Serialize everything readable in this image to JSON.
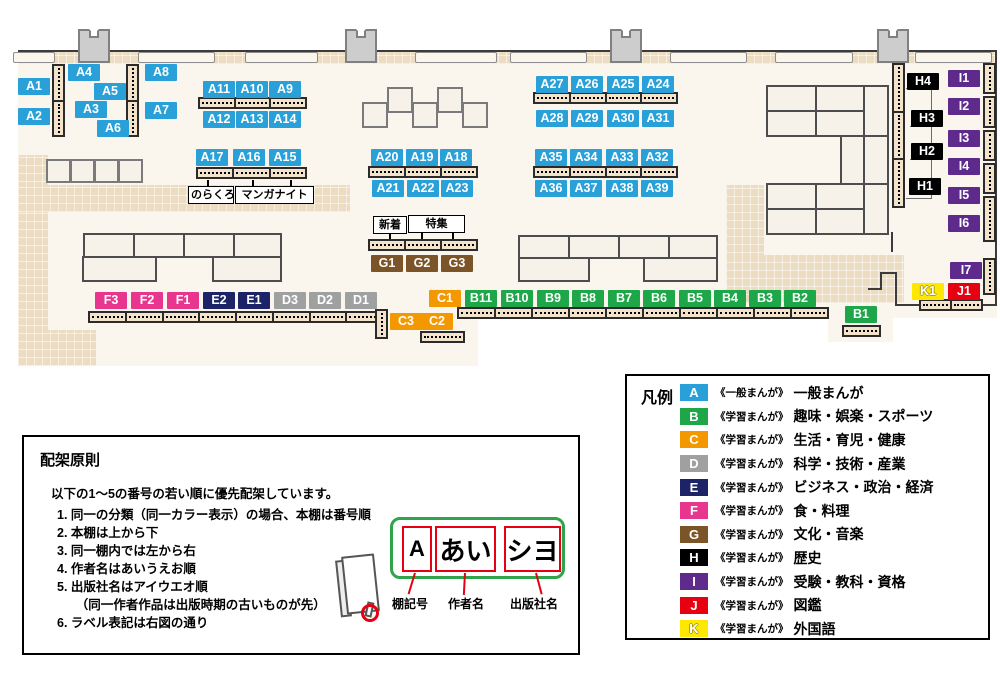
{
  "map": {
    "badges": {
      "A1": "A1",
      "A2": "A2",
      "A3": "A3",
      "A4": "A4",
      "A5": "A5",
      "A6": "A6",
      "A7": "A7",
      "A8": "A8",
      "A9": "A9",
      "A10": "A10",
      "A11": "A11",
      "A12": "A12",
      "A13": "A13",
      "A14": "A14",
      "A15": "A15",
      "A16": "A16",
      "A17": "A17",
      "A18": "A18",
      "A19": "A19",
      "A20": "A20",
      "A21": "A21",
      "A22": "A22",
      "A23": "A23",
      "A24": "A24",
      "A25": "A25",
      "A26": "A26",
      "A27": "A27",
      "A28": "A28",
      "A29": "A29",
      "A30": "A30",
      "A31": "A31",
      "A32": "A32",
      "A33": "A33",
      "A34": "A34",
      "A35": "A35",
      "A36": "A36",
      "A37": "A37",
      "A38": "A38",
      "A39": "A39",
      "B1": "B1",
      "B2": "B2",
      "B3": "B3",
      "B4": "B4",
      "B5": "B5",
      "B6": "B6",
      "B7": "B7",
      "B8": "B8",
      "B9": "B9",
      "B10": "B10",
      "B11": "B11",
      "C1": "C1",
      "C2": "C2",
      "C3": "C3",
      "D1": "D1",
      "D2": "D2",
      "D3": "D3",
      "E1": "E1",
      "E2": "E2",
      "F1": "F1",
      "F2": "F2",
      "F3": "F3",
      "G1": "G1",
      "G2": "G2",
      "G3": "G3",
      "H1": "H1",
      "H2": "H2",
      "H3": "H3",
      "H4": "H4",
      "I1": "I1",
      "I2": "I2",
      "I3": "I3",
      "I4": "I4",
      "I5": "I5",
      "I6": "I6",
      "I7": "I7",
      "J1": "J1",
      "K1": "K1"
    },
    "annotations": {
      "norakuro": "のらくろ",
      "manganight": "マンガナイト",
      "new_arrivals": "新着",
      "feature": "特集"
    }
  },
  "legend": {
    "title": "凡例",
    "items": [
      {
        "letter": "A",
        "category": "《一般まんが》",
        "label": "一般まんが",
        "color": "#29a0d8"
      },
      {
        "letter": "B",
        "category": "《学習まんが》",
        "label": "趣味・娯楽・スポーツ",
        "color": "#1ea748"
      },
      {
        "letter": "C",
        "category": "《学習まんが》",
        "label": "生活・育児・健康",
        "color": "#f39800"
      },
      {
        "letter": "D",
        "category": "《学習まんが》",
        "label": "科学・技術・産業",
        "color": "#9fa0a0"
      },
      {
        "letter": "E",
        "category": "《学習まんが》",
        "label": "ビジネス・政治・経済",
        "color": "#1c2467"
      },
      {
        "letter": "F",
        "category": "《学習まんが》",
        "label": "食・料理",
        "color": "#e8368f"
      },
      {
        "letter": "G",
        "category": "《学習まんが》",
        "label": "文化・音楽",
        "color": "#7b5527"
      },
      {
        "letter": "H",
        "category": "《学習まんが》",
        "label": "歴史",
        "color": "#000000"
      },
      {
        "letter": "I",
        "category": "《学習まんが》",
        "label": "受験・教科・資格",
        "color": "#5e2b8d"
      },
      {
        "letter": "J",
        "category": "《学習まんが》",
        "label": "図鑑",
        "color": "#e60012"
      },
      {
        "letter": "K",
        "category": "《学習まんが》",
        "label": "外国語",
        "color": "#ffe800"
      }
    ]
  },
  "principles": {
    "title": "配架原則",
    "intro": "以下の1～5の番号の若い順に優先配架しています。",
    "rules": [
      "1. 同一の分類（同一カラー表示）の場合、本棚は番号順",
      "2. 本棚は上から下",
      "3. 同一棚内では左から右",
      "4. 作者名はあいうえお順",
      "5. 出版社名はアイウエオ順",
      "　　（同一作者作品は出版時期の古いものが先）",
      "6. ラベル表記は右図の通り"
    ],
    "label_example": {
      "shelf_code": "A",
      "author": "あい",
      "publisher": "シヨ"
    },
    "captions": [
      "棚記号",
      "作者名",
      "出版社名"
    ]
  }
}
